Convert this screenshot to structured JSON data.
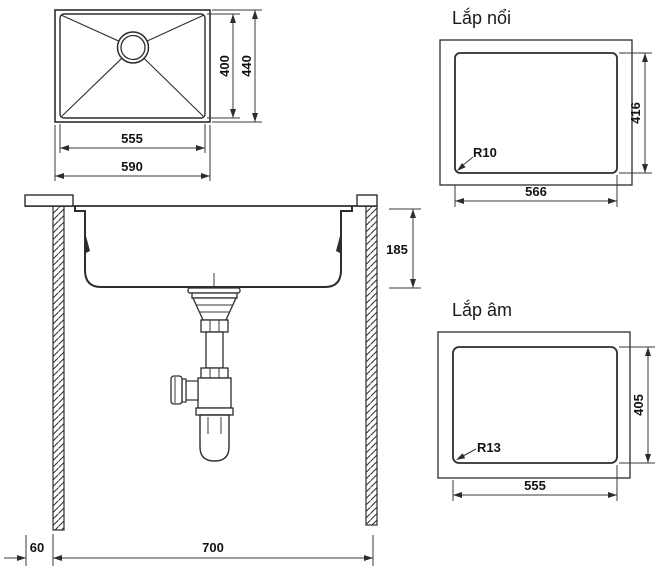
{
  "colors": {
    "background": "#ffffff",
    "line": "#2d2d2d",
    "text": "#121212"
  },
  "plan_view": {
    "inner_width": "555",
    "outer_width": "590",
    "inner_height": "400",
    "outer_height": "440"
  },
  "section_view": {
    "bowl_depth": "185",
    "left_offset": "60",
    "cabinet_width": "700"
  },
  "surface_mount_view": {
    "title": "Lắp nổi",
    "cutout_width": "566",
    "cutout_height": "416",
    "corner_radius": "R10"
  },
  "flush_mount_view": {
    "title": "Lắp âm",
    "cutout_width": "555",
    "cutout_height": "405",
    "corner_radius": "R13"
  }
}
